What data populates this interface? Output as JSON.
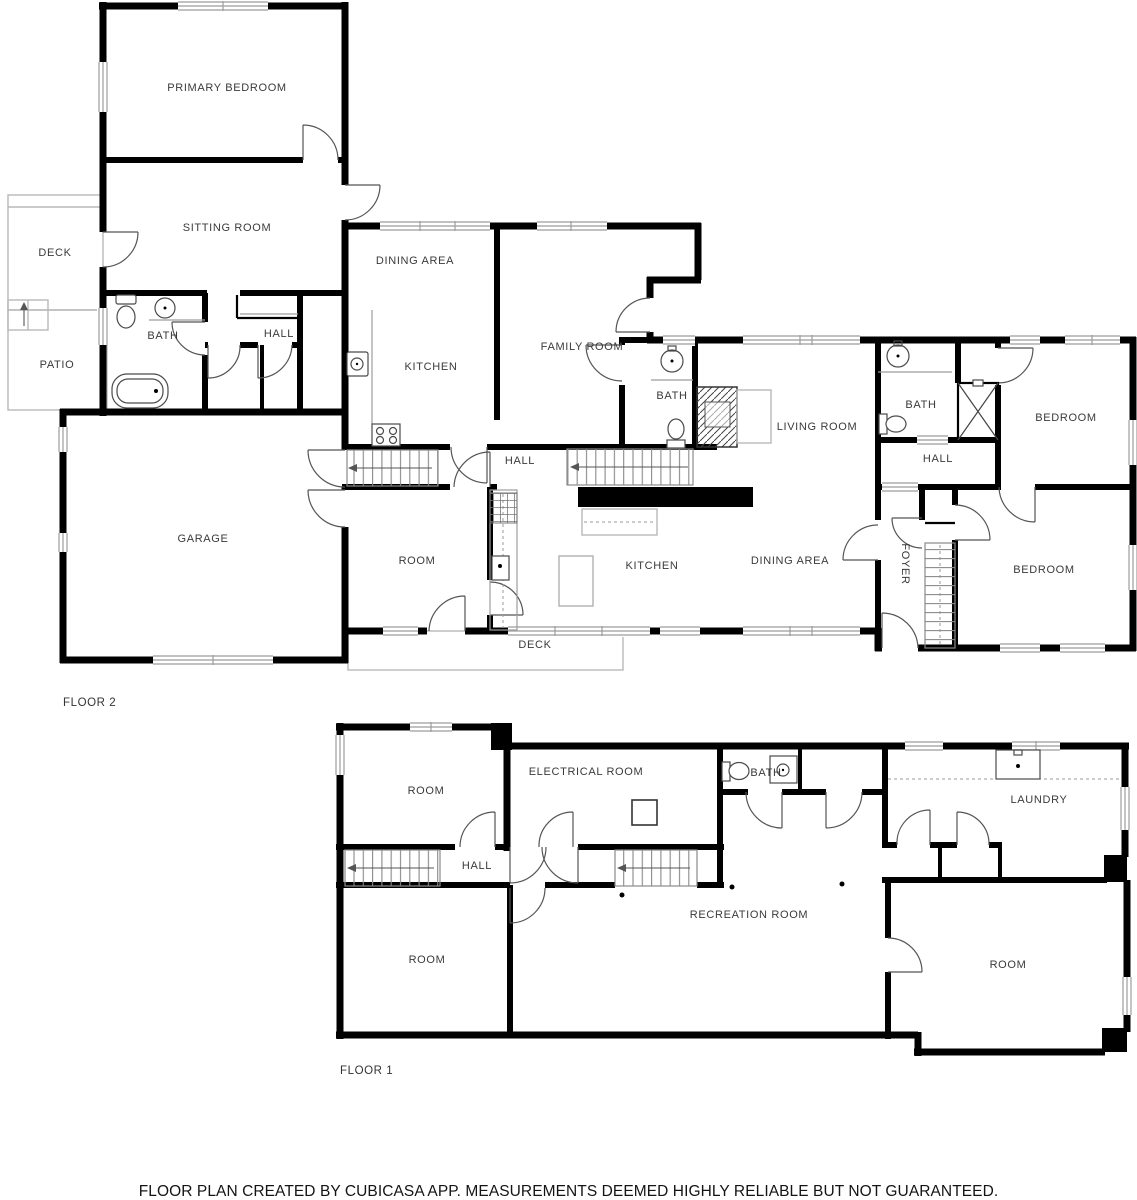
{
  "title": "Floor plan",
  "floors": [
    {
      "label": "FLOOR 2",
      "rooms": [
        {
          "label": "PRIMARY BEDROOM"
        },
        {
          "label": "SITTING ROOM"
        },
        {
          "label": "DECK"
        },
        {
          "label": "BATH"
        },
        {
          "label": "HALL"
        },
        {
          "label": "PATIO"
        },
        {
          "label": "DINING AREA"
        },
        {
          "label": "KITCHEN"
        },
        {
          "label": "FAMILY ROOM"
        },
        {
          "label": "BATH"
        },
        {
          "label": "LIVING ROOM"
        },
        {
          "label": "BATH"
        },
        {
          "label": "HALL"
        },
        {
          "label": "BEDROOM"
        },
        {
          "label": "HALL"
        },
        {
          "label": "GARAGE"
        },
        {
          "label": "ROOM"
        },
        {
          "label": "KITCHEN"
        },
        {
          "label": "DINING AREA"
        },
        {
          "label": "FOYER"
        },
        {
          "label": "BEDROOM"
        },
        {
          "label": "DECK"
        }
      ]
    },
    {
      "label": "FLOOR 1",
      "rooms": [
        {
          "label": "ROOM"
        },
        {
          "label": "ELECTRICAL ROOM"
        },
        {
          "label": "BATH"
        },
        {
          "label": "LAUNDRY"
        },
        {
          "label": "HALL"
        },
        {
          "label": "RECREATION ROOM"
        },
        {
          "label": "ROOM"
        },
        {
          "label": "ROOM"
        }
      ]
    }
  ],
  "footer": {
    "disclaimer": "FLOOR PLAN CREATED BY CUBICASA APP. MEASUREMENTS DEEMED HIGHLY RELIABLE BUT NOT GUARANTEED."
  },
  "colors": {
    "wall": "#000000",
    "window": "#9c9c9c",
    "label": "#3a3a3a",
    "background": "#ffffff"
  }
}
